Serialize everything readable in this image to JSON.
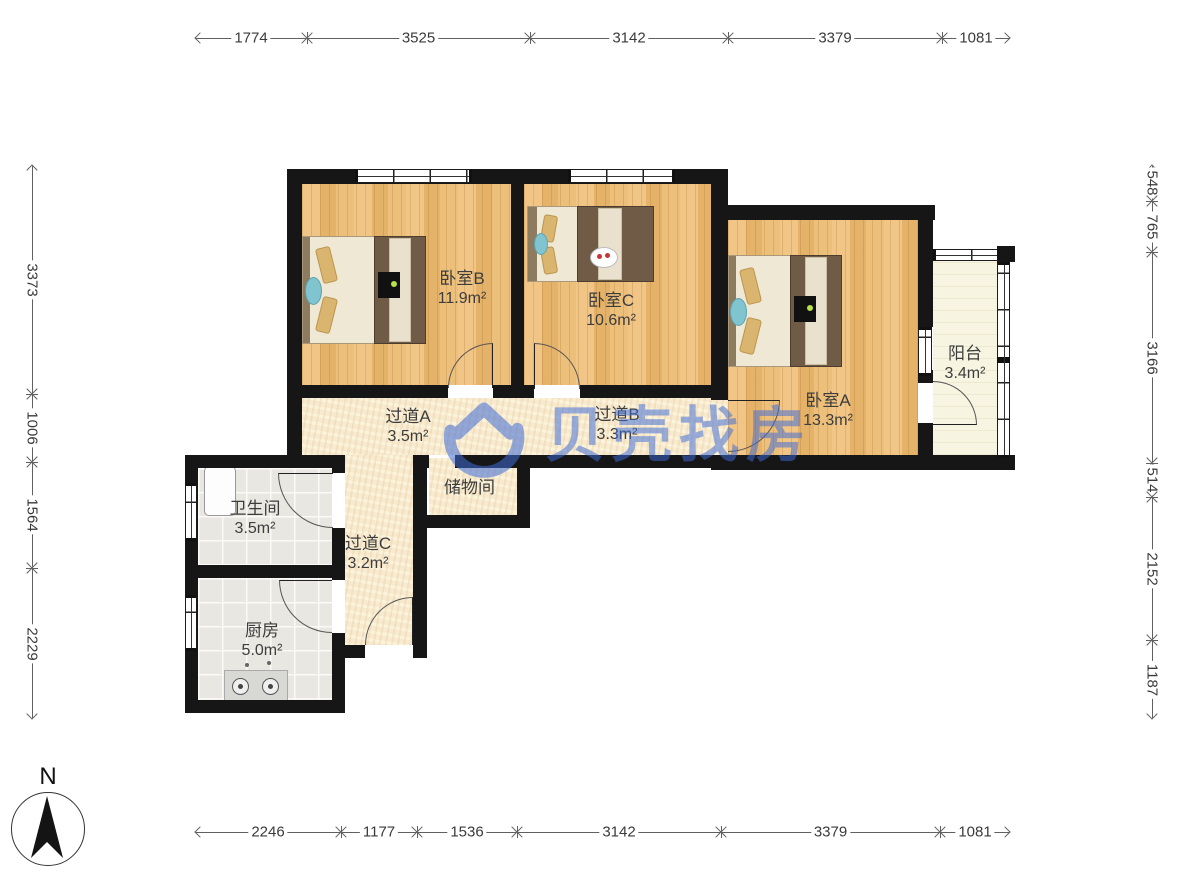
{
  "compass": {
    "label": "N"
  },
  "watermark": {
    "brand": "贝壳找房"
  },
  "rooms": {
    "bedroomB": {
      "name": "卧室B",
      "area": "11.9m²"
    },
    "bedroomC": {
      "name": "卧室C",
      "area": "10.6m²"
    },
    "bedroomA": {
      "name": "卧室A",
      "area": "13.3m²"
    },
    "balcony": {
      "name": "阳台",
      "area": "3.4m²"
    },
    "hallwayA": {
      "name": "过道A",
      "area": "3.5m²"
    },
    "hallwayB": {
      "name": "过道B",
      "area": "3.3m²"
    },
    "storage": {
      "name": "储物间"
    },
    "bathroom": {
      "name": "卫生间",
      "area": "3.5m²"
    },
    "hallwayC": {
      "name": "过道C",
      "area": "3.2m²"
    },
    "kitchen": {
      "name": "厨房",
      "area": "5.0m²"
    }
  },
  "dims": {
    "top": [
      "1774",
      "3525",
      "3142",
      "3379",
      "1081"
    ],
    "bottom": [
      "2246",
      "1177",
      "1536",
      "3142",
      "3379",
      "1081"
    ],
    "left": [
      "3373",
      "1006",
      "1564",
      "2229"
    ],
    "right": [
      "548",
      "765",
      "3166",
      "514",
      "2152",
      "1187"
    ]
  },
  "colors": {
    "wall": "#161616",
    "wood_floor": "#ecbf7b",
    "hall_floor": "#f7ead0",
    "tile_floor": "#e9e7e1",
    "watermark_blue": "#3e6cd8"
  }
}
